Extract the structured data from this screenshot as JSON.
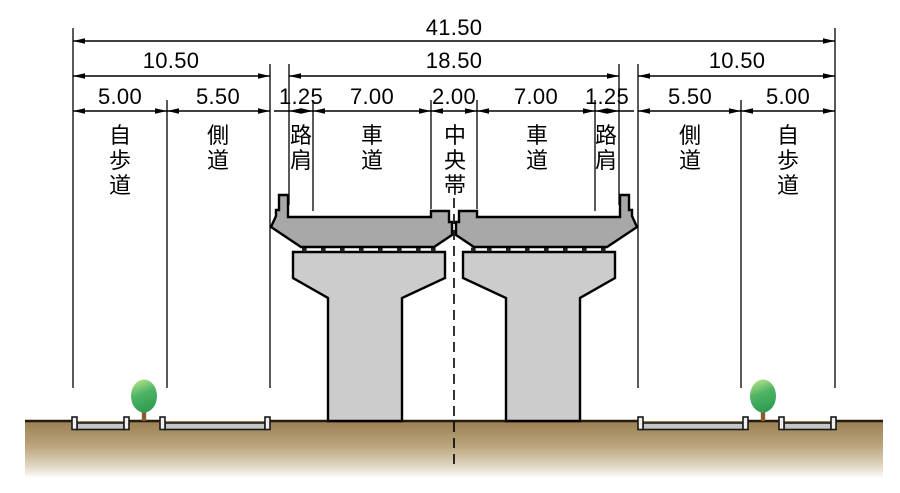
{
  "diagram_type": "road-bridge-cross-section",
  "dimensions": {
    "total": "41.50",
    "left_group": "10.50",
    "center_group": "18.50",
    "right_group": "10.50",
    "segments": [
      "5.00",
      "5.50",
      "1.25",
      "7.00",
      "2.00",
      "7.00",
      "1.25",
      "5.50",
      "5.00"
    ]
  },
  "zone_labels": [
    "自歩道",
    "側道",
    "路肩",
    "車道",
    "中央帯",
    "車道",
    "路肩",
    "側道",
    "自歩道"
  ],
  "colors": {
    "outline": "#000000",
    "deck_fill": "#a8a8a8",
    "pier_fill": "#cccccc",
    "soil_top": "#9a7f52",
    "soil_mid": "#bba67f",
    "soil_fade": "#ffffff",
    "road_slab": "#c6c6c6",
    "curb": "#f0f0f0",
    "tree_light": "#b8e48b",
    "tree_dark": "#2d9c50",
    "trunk": "#8a5c33"
  }
}
